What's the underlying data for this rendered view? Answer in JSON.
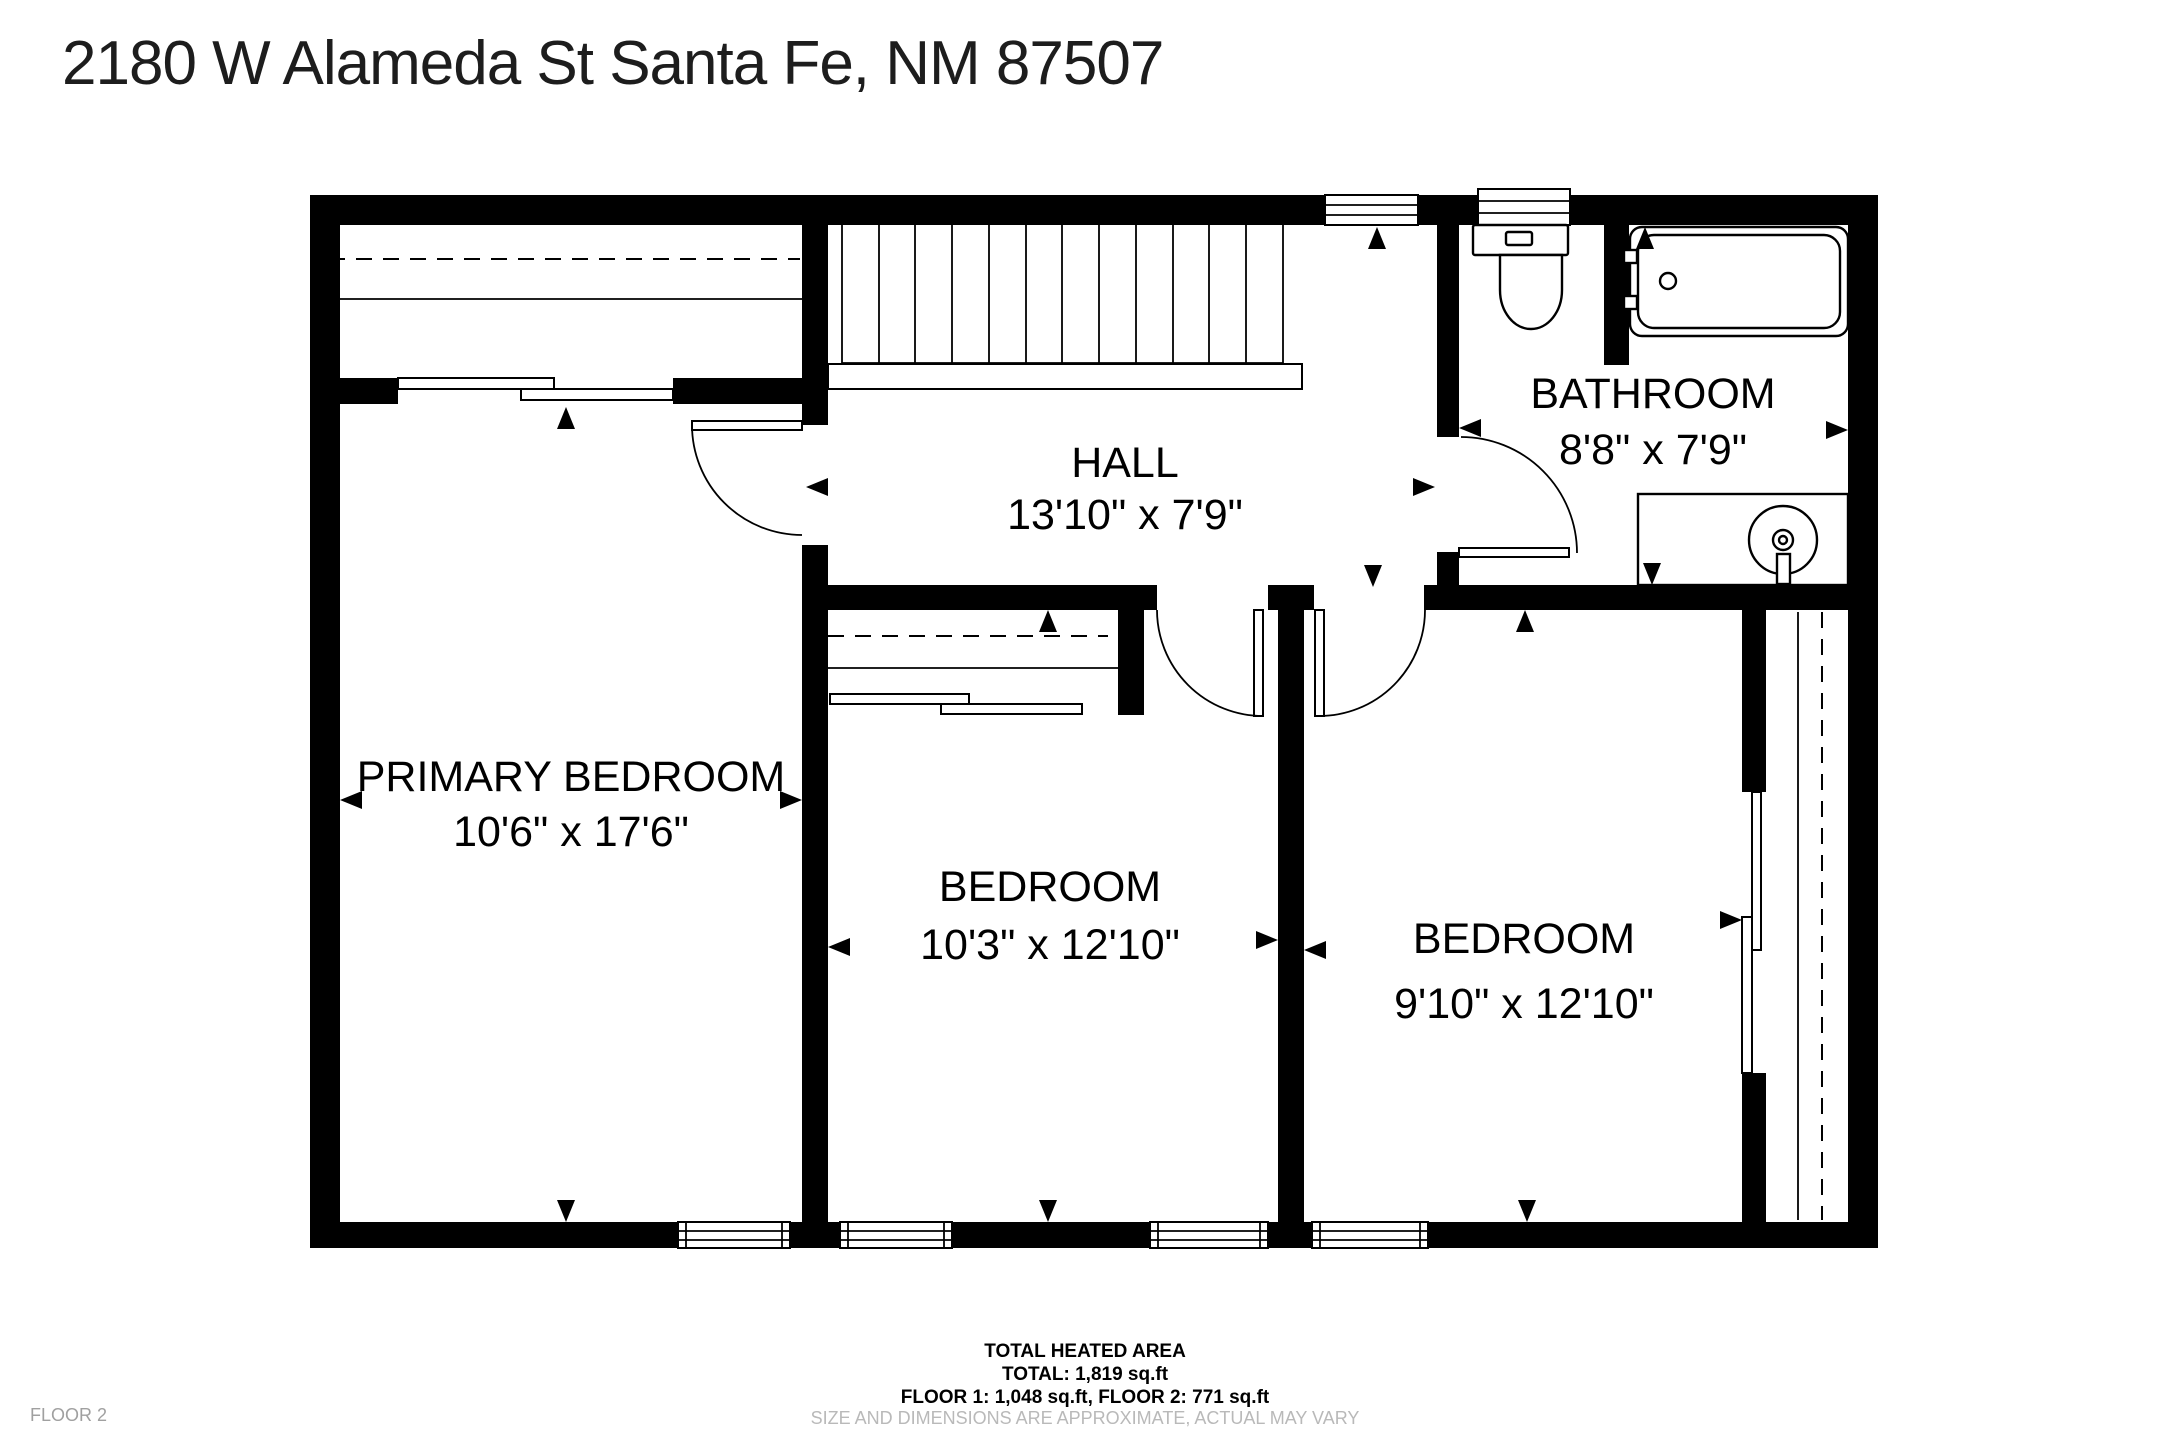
{
  "header": {
    "address": "2180 W Alameda St Santa Fe, NM 87507"
  },
  "rooms": {
    "primary": {
      "name": "PRIMARY BEDROOM",
      "dims": "10'6\" x 17'6\""
    },
    "hall": {
      "name": "HALL",
      "dims": "13'10\" x 7'9\""
    },
    "bathroom": {
      "name": "BATHROOM",
      "dims": "8'8\" x 7'9\""
    },
    "bedroom_mid": {
      "name": "BEDROOM",
      "dims": "10'3\" x 12'10\""
    },
    "bedroom_right": {
      "name": "BEDROOM",
      "dims": "9'10\" x 12'10\""
    }
  },
  "footer": {
    "line1": "TOTAL HEATED AREA",
    "line2": "TOTAL: 1,819 sq.ft",
    "line3": "FLOOR 1: 1,048 sq.ft, FLOOR 2: 771 sq.ft",
    "note": "SIZE AND DIMENSIONS ARE APPROXIMATE, ACTUAL MAY VARY"
  },
  "floor_label": "FLOOR 2",
  "icons": {
    "toilet": "toilet-icon",
    "bathtub": "bathtub-icon",
    "sink": "sink-icon",
    "stairs": "stairs-icon",
    "doors": "door-swing-icon",
    "windows": "window-icon",
    "closet_rod": "closet-rod-dashed-line",
    "dimension_arrows": "dimension-arrow-icon"
  },
  "colors": {
    "background": "#ffffff",
    "wall": "#000000",
    "text": "#000000",
    "muted_note": "#b9b9b9",
    "floor_label": "#a0a0a0"
  }
}
